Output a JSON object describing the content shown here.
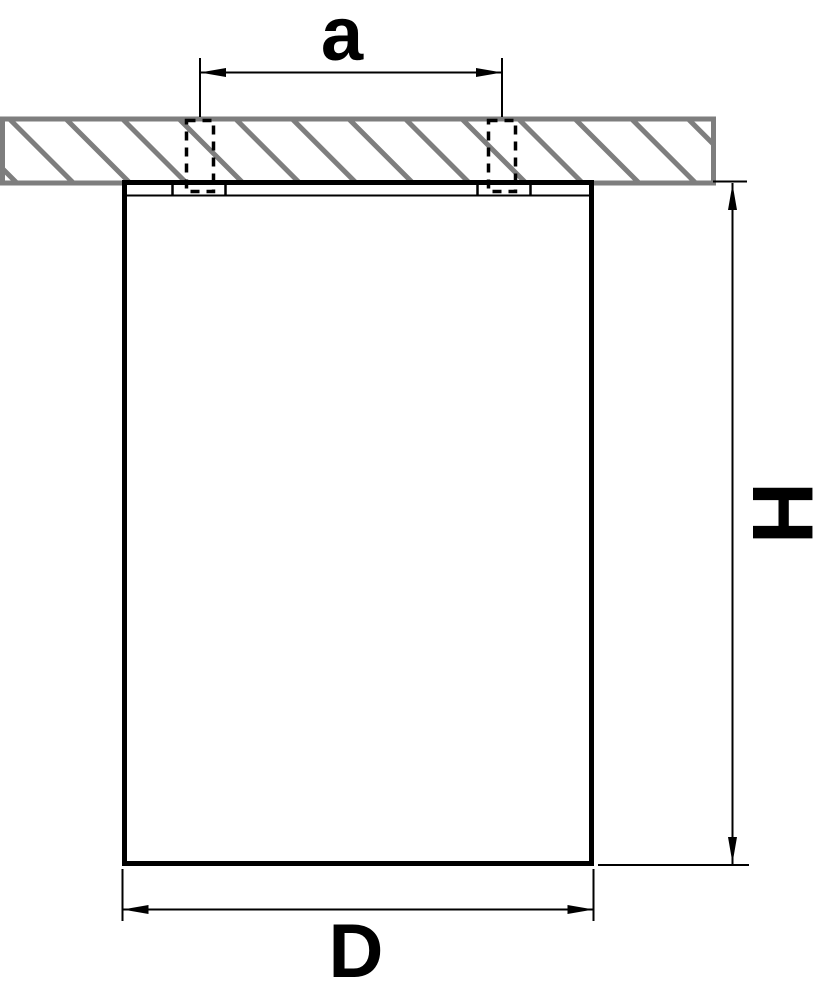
{
  "dimension_labels": {
    "hole_spacing": "a",
    "height": "H",
    "diameter": "D"
  },
  "colors": {
    "outline": "#000000",
    "hatch_gray": "#7e7e7e",
    "background": "#ffffff"
  }
}
